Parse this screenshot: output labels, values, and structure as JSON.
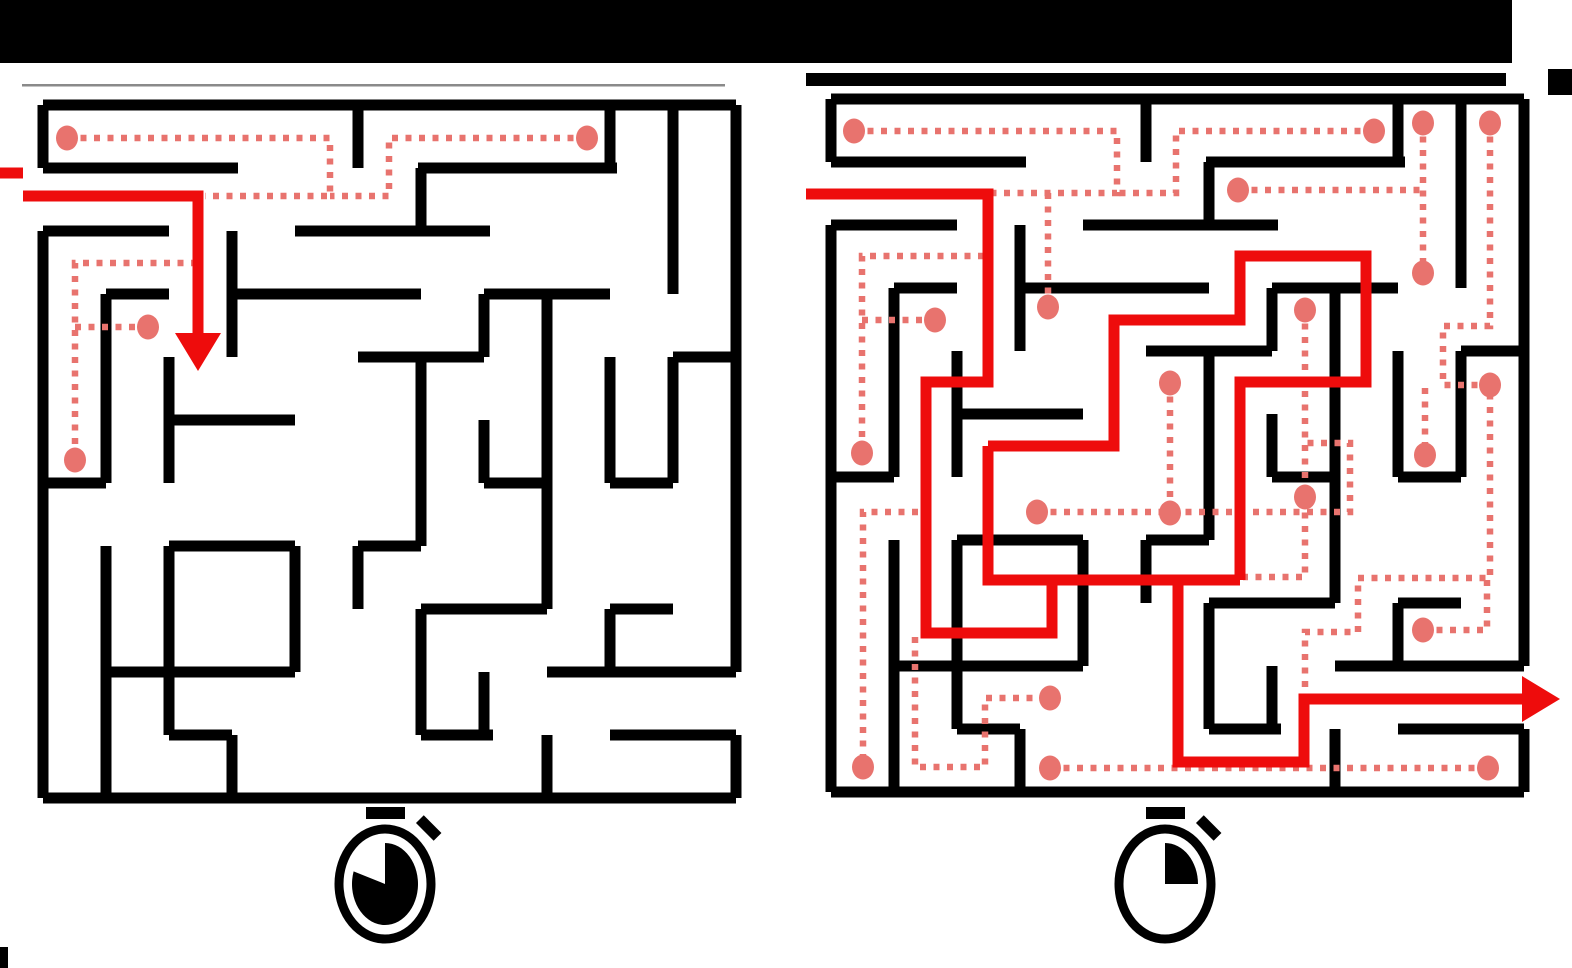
{
  "figure": {
    "description": "two-maze comparison figure: left maze with partial red entry path and few dotted explorations, right maze fully solved with red path and many dotted explorations, stopwatch icons below each maze",
    "canvas": {
      "width": 1572,
      "height": 968,
      "background": "#FFFFFF"
    },
    "colors": {
      "wall": "#000000",
      "solution_red": "#EE0C0C",
      "explore_dotted": "#E8736E",
      "separator_gray": "#8A8A8A",
      "bar_black": "#000000"
    },
    "stroke": {
      "wall_width": 11,
      "red_width": 11,
      "dot_width": 6.5,
      "dot_dash": "6 7.5",
      "endpoint_radius": 11
    },
    "decor": {
      "top_bar": {
        "x": 0,
        "y": 0,
        "w": 1512,
        "h": 63
      },
      "top_right_mark": {
        "x": 1548,
        "y": 69,
        "w": 24,
        "h": 26
      },
      "left_separator": {
        "x": 22,
        "y": 84,
        "w": 703,
        "h": 2.5
      },
      "right_separator": {
        "x": 806,
        "y": 73,
        "w": 700,
        "h": 13
      },
      "bottom_left_tab": {
        "x": 0,
        "y": 947,
        "w": 8,
        "h": 21
      }
    },
    "maze_grid": {
      "cells": 11,
      "cell_size": 63,
      "span": 693
    },
    "maze_walls": {
      "h": [
        [
          0,
          0,
          693
        ],
        [
          63,
          0,
          195
        ],
        [
          63,
          375,
          574
        ],
        [
          126,
          0,
          126
        ],
        [
          126,
          252,
          447
        ],
        [
          189,
          63,
          126
        ],
        [
          189,
          189,
          378
        ],
        [
          189,
          441,
          567
        ],
        [
          252,
          315,
          441
        ],
        [
          252,
          630,
          693
        ],
        [
          315,
          126,
          252
        ],
        [
          378,
          0,
          63
        ],
        [
          378,
          441,
          504
        ],
        [
          378,
          567,
          630
        ],
        [
          441,
          126,
          252
        ],
        [
          441,
          315,
          378
        ],
        [
          504,
          378,
          504
        ],
        [
          504,
          567,
          630
        ],
        [
          567,
          63,
          252
        ],
        [
          567,
          504,
          693
        ],
        [
          630,
          126,
          189
        ],
        [
          630,
          378,
          450
        ],
        [
          630,
          567,
          693
        ],
        [
          693,
          0,
          693
        ]
      ],
      "v": [
        [
          0,
          0,
          63
        ],
        [
          0,
          126,
          693
        ],
        [
          63,
          189,
          378
        ],
        [
          63,
          441,
          693
        ],
        [
          126,
          252,
          378
        ],
        [
          126,
          441,
          630
        ],
        [
          189,
          126,
          252
        ],
        [
          189,
          630,
          693
        ],
        [
          252,
          441,
          567
        ],
        [
          315,
          0,
          63
        ],
        [
          315,
          441,
          504
        ],
        [
          378,
          63,
          126
        ],
        [
          378,
          252,
          441
        ],
        [
          378,
          504,
          630
        ],
        [
          441,
          189,
          252
        ],
        [
          441,
          315,
          378
        ],
        [
          441,
          567,
          630
        ],
        [
          504,
          189,
          504
        ],
        [
          504,
          630,
          693
        ],
        [
          567,
          0,
          63
        ],
        [
          567,
          252,
          378
        ],
        [
          567,
          504,
          567
        ],
        [
          630,
          0,
          189
        ],
        [
          630,
          252,
          378
        ],
        [
          693,
          0,
          567
        ],
        [
          693,
          630,
          693
        ]
      ]
    },
    "mazes": [
      {
        "id": "maze-left-unsolved",
        "origin": [
          43,
          105
        ],
        "red_segments": [
          [
            [
              -43,
              68
            ],
            [
              -20,
              68
            ]
          ],
          [
            [
              -20,
              91
            ],
            [
              155,
              91
            ],
            [
              155,
              245
            ]
          ]
        ],
        "arrow": {
          "dir": "down",
          "tip": [
            155,
            266
          ]
        },
        "dotted": [
          {
            "points": [
              [
                24,
                33
              ],
              [
                287,
                33
              ],
              [
                287,
                91
              ],
              [
                162,
                91
              ]
            ],
            "dots": [
              [
                24,
                33
              ]
            ]
          },
          {
            "points": [
              [
                544,
                33
              ],
              [
                346,
                33
              ],
              [
                346,
                91
              ],
              [
                287,
                91
              ]
            ],
            "dots": [
              [
                544,
                33
              ]
            ]
          },
          {
            "points": [
              [
                154,
                158
              ],
              [
                32,
                158
              ],
              [
                32,
                355
              ]
            ],
            "dots": [
              [
                32,
                355
              ]
            ]
          },
          {
            "points": [
              [
                32,
                222
              ],
              [
                105,
                222
              ]
            ],
            "dots": [
              [
                105,
                222
              ]
            ]
          }
        ]
      },
      {
        "id": "maze-right-solved",
        "origin": [
          831,
          99
        ],
        "red_segments": [
          [
            [
              -25,
              95
            ],
            [
              157,
              95
            ],
            [
              157,
              283
            ],
            [
              95,
              283
            ],
            [
              95,
              534
            ],
            [
              221,
              534
            ],
            [
              221,
              481
            ],
            [
              347,
              481
            ],
            [
              347,
              663
            ],
            [
              473,
              663
            ],
            [
              473,
              600
            ],
            [
              705,
              600
            ]
          ],
          [
            [
              157,
              347
            ],
            [
              157,
              481
            ],
            [
              409,
              481
            ]
          ],
          [
            [
              157,
              347
            ],
            [
              283,
              347
            ],
            [
              283,
              221
            ],
            [
              409,
              221
            ],
            [
              409,
              157
            ],
            [
              535,
              157
            ],
            [
              535,
              283
            ],
            [
              409,
              283
            ],
            [
              409,
              481
            ]
          ]
        ],
        "arrow": {
          "dir": "right",
          "tip": [
            729,
            600
          ]
        },
        "dotted": [
          {
            "points": [
              [
                23,
                32
              ],
              [
                286,
                32
              ],
              [
                286,
                94
              ],
              [
                161,
                94
              ]
            ],
            "dots": [
              [
                23,
                32
              ]
            ]
          },
          {
            "points": [
              [
                543,
                32
              ],
              [
                345,
                32
              ],
              [
                345,
                94
              ],
              [
                286,
                94
              ]
            ],
            "dots": [
              [
                543,
                32
              ]
            ]
          },
          {
            "points": [
              [
                153,
                157
              ],
              [
                31,
                157
              ],
              [
                31,
                354
              ]
            ],
            "dots": [
              [
                31,
                354
              ]
            ]
          },
          {
            "points": [
              [
                31,
                221
              ],
              [
                104,
                221
              ]
            ],
            "dots": [
              [
                104,
                221
              ]
            ]
          },
          {
            "points": [
              [
                217,
                94
              ],
              [
                217,
                208
              ]
            ],
            "dots": [
              [
                217,
                208
              ]
            ]
          },
          {
            "points": [
              [
                407,
                91
              ],
              [
                592,
                91
              ]
            ],
            "dots": [
              [
                407,
                91
              ]
            ]
          },
          {
            "points": [
              [
                592,
                24
              ],
              [
                592,
                174
              ]
            ],
            "dots": [
              [
                592,
                24
              ],
              [
                592,
                174
              ]
            ]
          },
          {
            "points": [
              [
                659,
                24
              ],
              [
                659,
                227
              ],
              [
                612,
                227
              ],
              [
                612,
                286
              ],
              [
                659,
                286
              ],
              [
                659,
                479
              ],
              [
                527,
                479
              ],
              [
                527,
                533
              ],
              [
                474,
                533
              ],
              [
                474,
                596
              ]
            ],
            "dots": [
              [
                659,
                24
              ],
              [
                659,
                286
              ]
            ]
          },
          {
            "points": [
              [
                592,
                531
              ],
              [
                656,
                531
              ],
              [
                656,
                479
              ]
            ],
            "dots": [
              [
                592,
                531
              ]
            ]
          },
          {
            "points": [
              [
                474,
                211
              ],
              [
                474,
                478
              ],
              [
                412,
                478
              ]
            ],
            "dots": [
              [
                474,
                211
              ],
              [
                474,
                398
              ]
            ]
          },
          {
            "points": [
              [
                206,
                413
              ],
              [
                519,
                413
              ],
              [
                519,
                344
              ],
              [
                474,
                344
              ]
            ],
            "dots": [
              [
                206,
                413
              ]
            ]
          },
          {
            "points": [
              [
                87,
                413
              ],
              [
                32,
                413
              ],
              [
                32,
                668
              ]
            ],
            "dots": [
              [
                32,
                668
              ]
            ]
          },
          {
            "points": [
              [
                84,
                538
              ],
              [
                84,
                668
              ],
              [
                154,
                668
              ],
              [
                154,
                599
              ],
              [
                219,
                599
              ]
            ],
            "dots": [
              [
                219,
                599
              ]
            ]
          },
          {
            "points": [
              [
                219,
                669
              ],
              [
                657,
                669
              ]
            ],
            "dots": [
              [
                219,
                669
              ],
              [
                657,
                669
              ]
            ]
          },
          {
            "points": [
              [
                339,
                284
              ],
              [
                339,
                414
              ]
            ],
            "dots": [
              [
                339,
                284
              ],
              [
                339,
                414
              ]
            ]
          },
          {
            "points": [
              [
                594,
                289
              ],
              [
                594,
                356
              ]
            ],
            "dots": [
              [
                594,
                356
              ]
            ]
          }
        ]
      }
    ],
    "stopwatches": [
      {
        "id": "stopwatch-icon-left",
        "center": [
          385,
          884
        ],
        "fill_fraction": 0.8
      },
      {
        "id": "stopwatch-icon-right",
        "center": [
          1165,
          884
        ],
        "fill_fraction": 0.25
      }
    ]
  }
}
